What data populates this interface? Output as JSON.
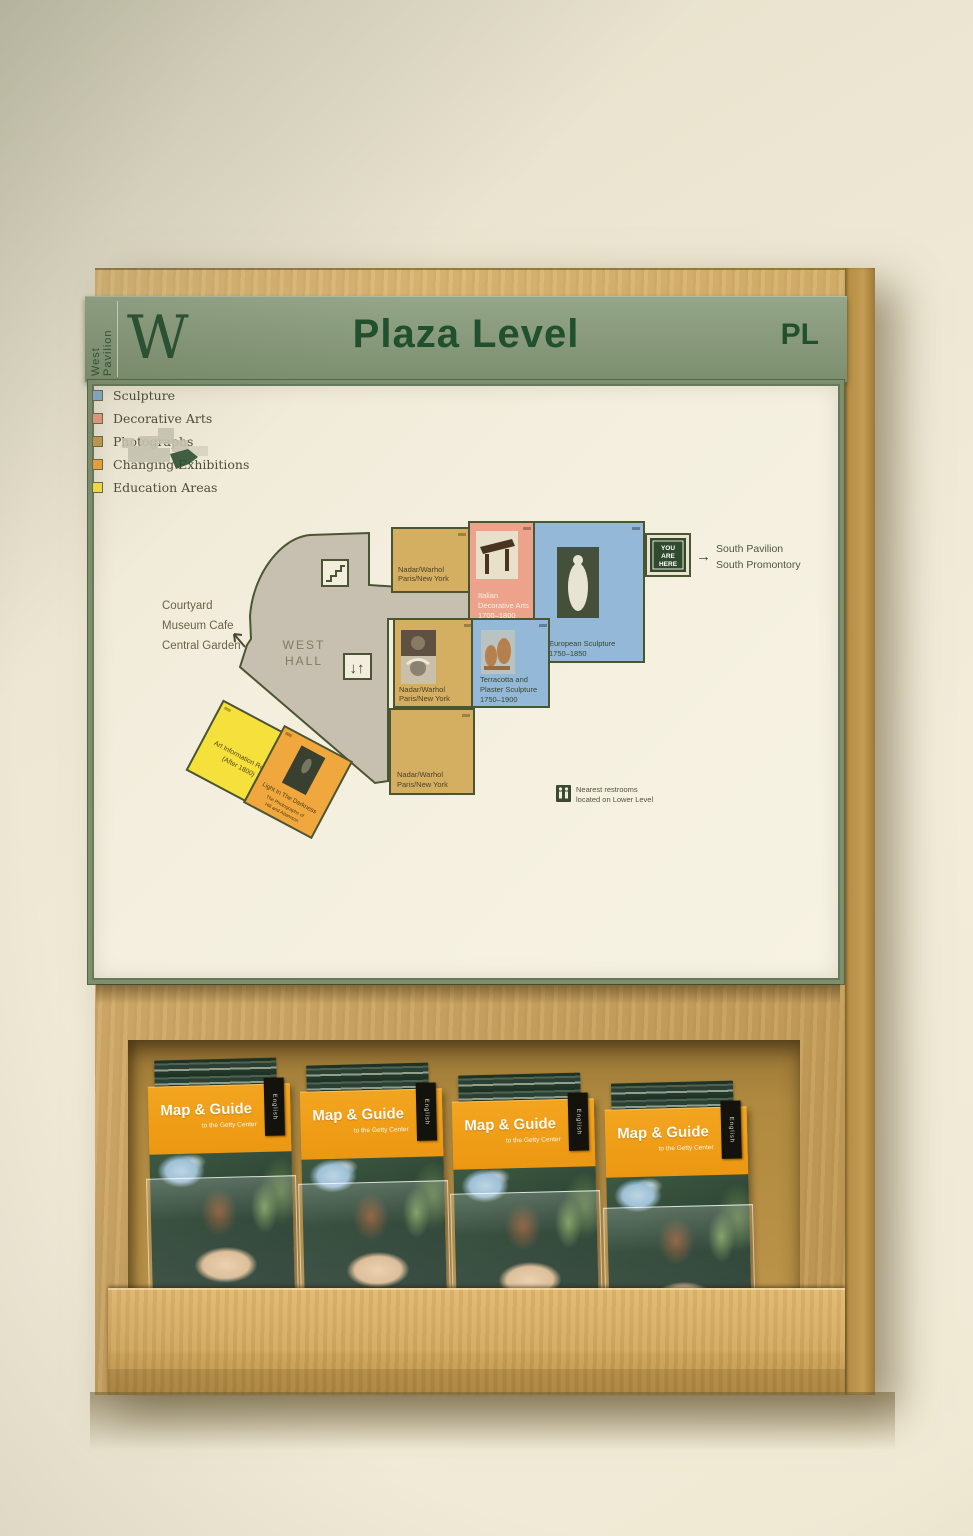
{
  "sign": {
    "pavilion_code": "W",
    "pavilion_name": "West Pavilion",
    "level_name": "Plaza Level",
    "level_abbr": "PL"
  },
  "floorplan": {
    "hall_label": [
      "WEST",
      "HALL"
    ],
    "exit_west": [
      "Courtyard",
      "Museum Cafe",
      "Central Garden"
    ],
    "exit_south": [
      "South Pavilion",
      "South Promontory"
    ],
    "you_are_here": [
      "YOU",
      "ARE",
      "HERE"
    ],
    "restrooms_note": [
      "Nearest restrooms",
      "located on Lower Level"
    ],
    "rooms": {
      "photographs_north": [
        "Nadar/Warhol",
        "Paris/New York"
      ],
      "decorative_arts": [
        "Italian",
        "Decorative Arts",
        "1700–1800"
      ],
      "sculpture_east": [
        "European Sculpture",
        "1750–1850"
      ],
      "photographs_center": [
        "Nadar/Warhol",
        "Paris/New York"
      ],
      "sculpture_terracotta": [
        "Terracotta and",
        "Plaster Sculpture",
        "1750–1900"
      ],
      "photographs_south": [
        "Nadar/Warhol",
        "Paris/New York"
      ],
      "education": [
        "Art Information Room",
        "(After 1800)"
      ],
      "changing_exhibition": [
        "Light In The Darkness",
        "The Photographs of",
        "Hill and Adamson"
      ]
    },
    "legend": [
      {
        "label": "Sculpture",
        "swatch": "background:#85aac8"
      },
      {
        "label": "Decorative Arts",
        "swatch": "background:#e39a7e"
      },
      {
        "label": "Photographs",
        "swatch": "background:#c09a52"
      },
      {
        "label": "Changing Exhibitions",
        "swatch": "background:#eaa23e"
      },
      {
        "label": "Education Areas",
        "swatch": "background:#f2dd49"
      }
    ]
  },
  "rack": {
    "brochure_title": "Map & Guide",
    "brochure_subtitle": "to the Getty Center",
    "language_tab": "English",
    "stack_count": "4"
  },
  "palette": {
    "header_green": "#87997a",
    "header_text": "#21502e",
    "wood": "#cfa660",
    "panel": "#f4efdf",
    "plan_outline": "#4a5531",
    "hall_gray": "#c7c0b1",
    "room_sculpture_blue": "#93b8d8",
    "room_decorative_pink": "#eca28b",
    "room_photographs_tan": "#d4af62",
    "room_changing_orange": "#f0a83e",
    "room_education_yellow": "#f6e03c",
    "brochure_orange": "#f09c1c",
    "you_are_here_green": "#2f4a2e"
  }
}
